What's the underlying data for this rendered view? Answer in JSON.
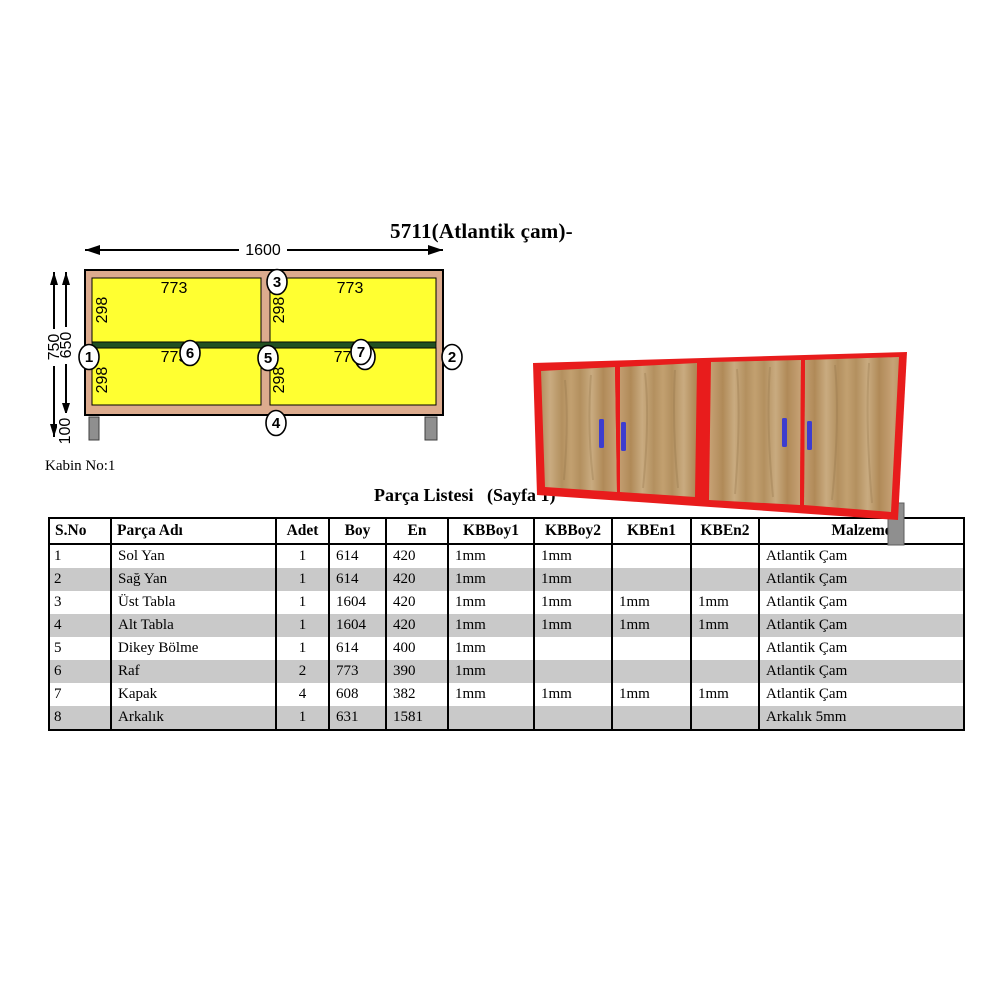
{
  "page": {
    "title": "5711(Atlantik çam)-",
    "cabin_label": "Kabin No:1",
    "list_heading": "Parça Listesi   (Sayfa 1)"
  },
  "diagram": {
    "overall_width": "1600",
    "overall_height": "750",
    "body_height": "650",
    "leg_height": "100",
    "compartment_width": "773",
    "compartment_height": "298",
    "markers": [
      "1",
      "2",
      "3",
      "4",
      "5",
      "6",
      "7",
      "8"
    ]
  },
  "table": {
    "headers": [
      "S.No",
      "Parça Adı",
      "Adet",
      "Boy",
      "En",
      "KBBoy1",
      "KBBoy2",
      "KBEn1",
      "KBEn2",
      "Malzeme"
    ],
    "rows": [
      [
        "1",
        "Sol Yan",
        "1",
        "614",
        "420",
        "1mm",
        "1mm",
        "",
        "",
        "Atlantik Çam"
      ],
      [
        "2",
        "Sağ Yan",
        "1",
        "614",
        "420",
        "1mm",
        "1mm",
        "",
        "",
        "Atlantik Çam"
      ],
      [
        "3",
        "Üst Tabla",
        "1",
        "1604",
        "420",
        "1mm",
        "1mm",
        "1mm",
        "1mm",
        "Atlantik Çam"
      ],
      [
        "4",
        "Alt Tabla",
        "1",
        "1604",
        "420",
        "1mm",
        "1mm",
        "1mm",
        "1mm",
        "Atlantik Çam"
      ],
      [
        "5",
        "Dikey Bölme",
        "1",
        "614",
        "400",
        "1mm",
        "",
        "",
        "",
        "Atlantik Çam"
      ],
      [
        "6",
        "Raf",
        "2",
        "773",
        "390",
        "1mm",
        "",
        "",
        "",
        "Atlantik Çam"
      ],
      [
        "7",
        "Kapak",
        "4",
        "608",
        "382",
        "1mm",
        "1mm",
        "1mm",
        "1mm",
        "Atlantik Çam"
      ],
      [
        "8",
        "Arkalık",
        "1",
        "631",
        "1581",
        "",
        "",
        "",
        "",
        "Arkalık 5mm"
      ]
    ]
  },
  "colors": {
    "panel_yellow": "#ffff31",
    "frame_tan": "#dcab8e",
    "shelf_green": "#215021",
    "leg_gray": "#8f8f8f",
    "render_red": "#e81c1c",
    "handle_blue": "#3d3dcf",
    "wood_mid": "#bd9a6b",
    "row_stripe": "#c9c9c9"
  }
}
